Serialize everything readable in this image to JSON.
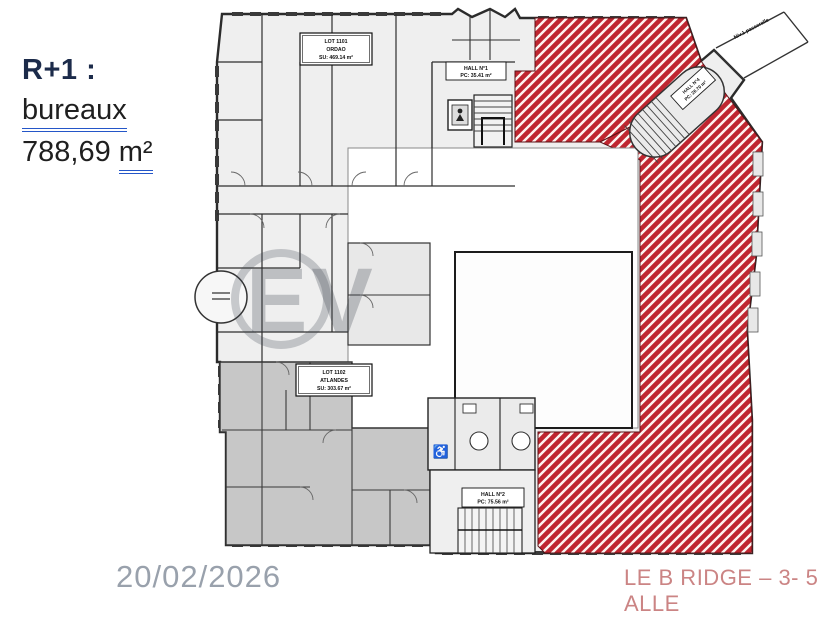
{
  "annotations": {
    "floor_label": "R+1 :",
    "usage_label": "bureaux",
    "area_value": "788,69",
    "area_unit": "m²",
    "date": "20/02/2026",
    "footer_right": "LE B RIDGE – 3- 5 ALLE"
  },
  "plan": {
    "lots": [
      {
        "line1": "LOT 1101",
        "line2": "ORDAO",
        "line3": "SU: 469.14 m²"
      },
      {
        "line1": "LOT 1102",
        "line2": "ATLANDES",
        "line3": "SU: 303.67 m²"
      }
    ],
    "halls": [
      {
        "line1": "HALL N°1",
        "line2": "PC: 35.41 m²"
      },
      {
        "line1": "HALL N°2",
        "line2": "PC: 75.56 m²"
      },
      {
        "line1": "HALL N°4",
        "line2": "PC: 26.70 m²"
      }
    ],
    "passerelle_label": "Niv.1 passerelle",
    "watermark": "EV",
    "colors": {
      "hatch_red": "#bf2630",
      "zone_gray": "#c7c7c7",
      "wall_dark": "#2b2b2b",
      "underline_blue": "#2456c8",
      "title_navy": "#1c2b4a",
      "date_gray": "#99a1ac",
      "footer_red": "#cb8484"
    }
  }
}
